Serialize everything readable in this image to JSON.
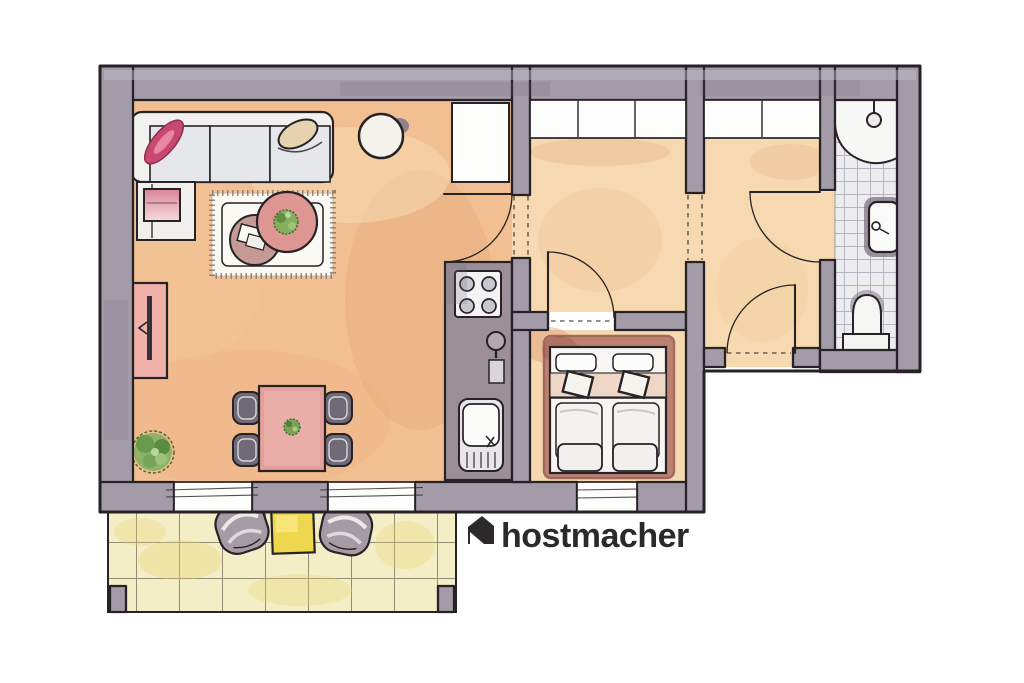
{
  "logo": {
    "text": "hostmacher",
    "icon": "house-icon"
  },
  "colors": {
    "ink": "#262226",
    "paper": "#fdfdfb",
    "wall": "#a39ba8",
    "wall_dark": "#837a88",
    "floor_living": "#f2bf92",
    "floor_rooms": "#f6d9b0",
    "bath_tile": "#ededf0",
    "bath_tile_line": "#b7b4c1",
    "terrace_tile": "#f4eec6",
    "terrace_tile_line": "#918d77",
    "accent_pink_deep": "#c8496f",
    "rug_rose": "#bd8172",
    "table_pink": "#dd9691",
    "chair_gray": "#6f6a75",
    "counter_gray": "#9c8f98",
    "plant_green": "#7ca253",
    "terrace_table_yellow": "#eed64d",
    "bed_band": "#eed7c6",
    "ottoman_pink": "#e9a8b2",
    "tvboard_pink": "#efb1a8",
    "logo": "#2c292b"
  },
  "scene": {
    "type": "watercolor-floor-plan",
    "rooms": [
      "living-room",
      "hall",
      "bedroom",
      "entry",
      "bathroom",
      "terrace"
    ],
    "furniture": {
      "living_room": [
        "corner-sofa",
        "pink-pillow",
        "bolster-cushion",
        "ottoman",
        "round-side-table",
        "area-rug",
        "coffee-table-large",
        "coffee-table-small",
        "books",
        "potted-plant-large",
        "tv-sideboard",
        "dining-table",
        "dining-chairs-x4",
        "tall-cabinet"
      ],
      "kitchen": [
        "kitchen-counter",
        "stove-4-burners",
        "faucet",
        "cutting-board",
        "sink-with-drainer"
      ],
      "bedroom": [
        "double-bed",
        "pillows-x2",
        "headboard-cushions-x2",
        "duvets-x2",
        "foot-cushions-x2",
        "bedroom-rug"
      ],
      "bathroom": [
        "corner-shower",
        "shower-head",
        "washbasin",
        "toilet"
      ],
      "terrace": [
        "lounge-chair-left",
        "lounge-chair-right",
        "yellow-side-table",
        "tile-paving"
      ],
      "openings": [
        "living-hall-door",
        "hall-bedroom-door",
        "entry-bathroom-door",
        "front-door",
        "terrace-sliding-door-left",
        "terrace-sliding-door-right",
        "hall-window",
        "entry-window",
        "bedroom-window"
      ]
    }
  }
}
